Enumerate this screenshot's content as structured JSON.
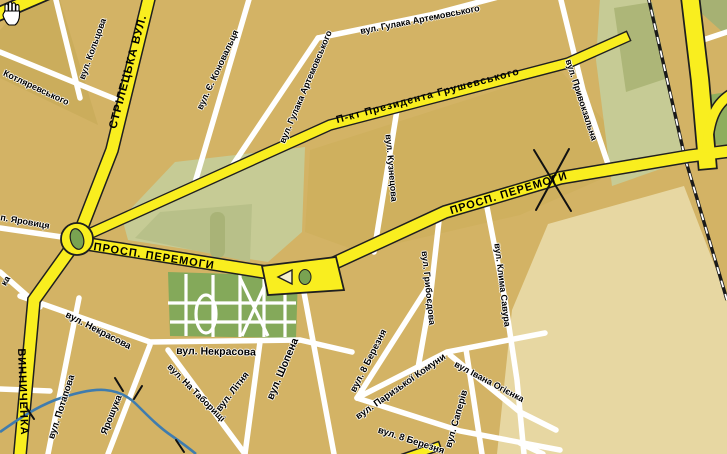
{
  "map": {
    "title": "city-street-map",
    "cursor": "hand-grab",
    "colors": {
      "background_tan": "#d3b365",
      "block_dark_tan": "#cbad5c",
      "block_light_beige": "#e7d7a2",
      "park_green": "#84a95a",
      "sage_green": "#c6cb95",
      "olive_green": "#a9b377",
      "ne_green": "#8fae5e",
      "road_yellow": "#f9ee1f",
      "road_casing": "#1f1f1f",
      "road_white": "#ffffff",
      "river_blue": "#3f7cae",
      "label_black": "#000000"
    },
    "labels": [
      {
        "id": "striletska",
        "text": "СТРІЛЕЦЬКА ВУЛ.",
        "x": 129,
        "y": 72,
        "rot": -75,
        "size": 11.5,
        "kind": "road"
      },
      {
        "id": "vynnychenka",
        "text": "ВИННИЧЕНКА",
        "x": 22,
        "y": 392,
        "rot": 88,
        "size": 11,
        "kind": "road"
      },
      {
        "id": "peremohy-west",
        "text": "ПРОСП. ПЕРЕМОГИ",
        "x": 154,
        "y": 257,
        "rot": 9,
        "size": 11,
        "kind": "road"
      },
      {
        "id": "peremohy-east",
        "text": "ПРОСП. ПЕРЕМОГИ",
        "x": 509,
        "y": 194,
        "rot": -17,
        "size": 11,
        "kind": "road"
      },
      {
        "id": "hrushevskoho",
        "text": "П-кт  Президента Грушевського",
        "x": 428,
        "y": 96,
        "rot": -15,
        "size": 10.5,
        "kind": "road"
      },
      {
        "id": "koltsova",
        "text": "вул. Кольцова",
        "x": 93,
        "y": 49,
        "rot": -70,
        "size": 9,
        "kind": "street"
      },
      {
        "id": "kotliarevskoho",
        "text": "Котляревського",
        "x": 36,
        "y": 88,
        "rot": 25,
        "size": 9,
        "kind": "street"
      },
      {
        "id": "yarovytsia",
        "text": "п. Яровиця",
        "x": 25,
        "y": 222,
        "rot": 10,
        "size": 9,
        "kind": "street"
      },
      {
        "id": "ka-fragment",
        "text": "ка",
        "x": 6,
        "y": 281,
        "rot": -60,
        "size": 9,
        "kind": "street"
      },
      {
        "id": "konovaltsia",
        "text": "вул. Є. Коновальця",
        "x": 218,
        "y": 70,
        "rot": -65,
        "size": 9,
        "kind": "street"
      },
      {
        "id": "hulaka-artemovskoho-diag",
        "text": "вул. Гулака Артемовського",
        "x": 306,
        "y": 87,
        "rot": -67,
        "size": 9,
        "kind": "street"
      },
      {
        "id": "hulaka-artemovskoho-horiz",
        "text": "вул. Гулака Артемовського",
        "x": 420,
        "y": 20,
        "rot": -11,
        "size": 9,
        "kind": "street"
      },
      {
        "id": "pryvokzalna",
        "text": "вул. Привокзальна",
        "x": 581,
        "y": 100,
        "rot": 72,
        "size": 9,
        "kind": "street"
      },
      {
        "id": "kuznetsova",
        "text": "вул. Кузнецова",
        "x": 391,
        "y": 168,
        "rot": 85,
        "size": 9,
        "kind": "street"
      },
      {
        "id": "hryboiedova",
        "text": "вул. Грибоєдова",
        "x": 428,
        "y": 288,
        "rot": 84,
        "size": 9,
        "kind": "street"
      },
      {
        "id": "klyma-savura",
        "text": "вул. Клима Савура",
        "x": 502,
        "y": 285,
        "rot": 83,
        "size": 9,
        "kind": "street"
      },
      {
        "id": "nekrasova-diag",
        "text": "вул. Некрасова",
        "x": 98,
        "y": 331,
        "rot": 27,
        "size": 9.5,
        "kind": "street"
      },
      {
        "id": "nekrasova-horiz",
        "text": "вул. Некрасова",
        "x": 216,
        "y": 352,
        "rot": 1,
        "size": 10.5,
        "kind": "street"
      },
      {
        "id": "potapova",
        "text": "вул. Потапова",
        "x": 62,
        "y": 407,
        "rot": -72,
        "size": 9.5,
        "kind": "street"
      },
      {
        "id": "yaroshuka",
        "text": "Ярошука",
        "x": 112,
        "y": 415,
        "rot": -68,
        "size": 9.5,
        "kind": "street"
      },
      {
        "id": "na-taboryshchi",
        "text": "вул. На  Таборищі",
        "x": 196,
        "y": 393,
        "rot": 45,
        "size": 9,
        "kind": "street"
      },
      {
        "id": "litnia",
        "text": "вул. Літня",
        "x": 233,
        "y": 392,
        "rot": -52,
        "size": 9.5,
        "kind": "street"
      },
      {
        "id": "shopena",
        "text": "вул. Шопена",
        "x": 283,
        "y": 369,
        "rot": -67,
        "size": 10.5,
        "kind": "street"
      },
      {
        "id": "berezni8-upper",
        "text": "вул. 8 Березня",
        "x": 369,
        "y": 361,
        "rot": -63,
        "size": 9.5,
        "kind": "street"
      },
      {
        "id": "paryzkoi-komuny",
        "text": "вул. Паризької Комуни",
        "x": 401,
        "y": 387,
        "rot": -35,
        "size": 9.5,
        "kind": "street"
      },
      {
        "id": "berezni8-lower",
        "text": "вул. 8 Березня",
        "x": 411,
        "y": 441,
        "rot": 18,
        "size": 9.5,
        "kind": "street"
      },
      {
        "id": "saperiv",
        "text": "вул. Саперів",
        "x": 457,
        "y": 419,
        "rot": -74,
        "size": 9.5,
        "kind": "street"
      },
      {
        "id": "ivana-ohiienka",
        "text": "вул Івана Огієнка",
        "x": 489,
        "y": 382,
        "rot": 28,
        "size": 9,
        "kind": "street"
      }
    ]
  }
}
